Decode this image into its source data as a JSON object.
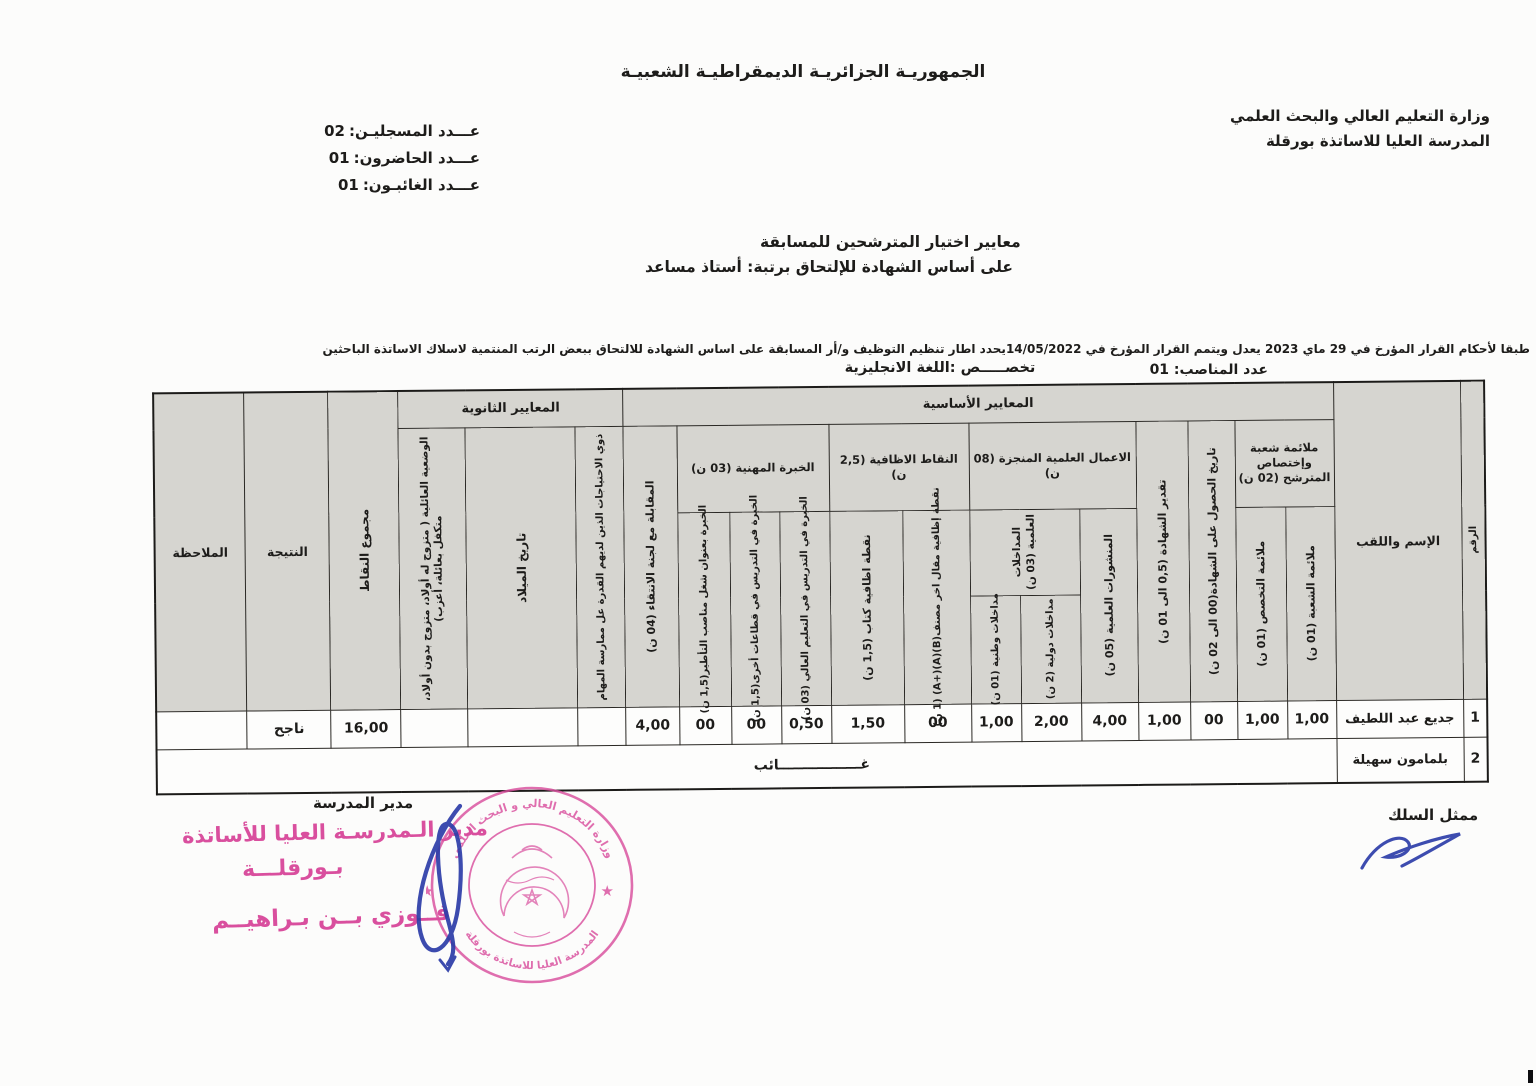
{
  "header": {
    "republic_title": "الجمهوريـة الجزائريـة الديمقراطيـة الشعبيـة",
    "ministry_line1": "وزارة التعليم العالي والبحث العلمي",
    "ministry_line2": "المدرسة العليا للاساتذة بورقلة",
    "stats": [
      {
        "label": "عـــدد المسجليـن:",
        "value": "02"
      },
      {
        "label": "عـــدد الحاضرون:",
        "value": "01"
      },
      {
        "label": "عـــدد الغائبـون:",
        "value": "01"
      }
    ],
    "title_line1": "معايير اختيار المترشحين للمسابقة",
    "title_line2": "على أساس الشهادة للإلتحاق برتبة: أستاذ مساعد",
    "decree_text": "طبقا لأحكام القرار المؤرخ في 29 ماي 2023 يعدل ويتمم القرار المؤرخ في 14/05/2022يحدد اطار تنظيم التوظيف و/أر المسابقة على اساس الشهادة للالتحاق ببعض الرتب المنتمية لاسلاك الاساتذة الباحثين",
    "posts_label": "عدد المناصب:",
    "posts_value": "01",
    "specialty_text": "تخصـــــص :اللغة الانجليزية"
  },
  "table": {
    "headers": {
      "num": "الرقم",
      "name": "الإسم واللقب",
      "basic_band": "المعايير الأساسية",
      "secondary_band": "المعايير الثانوية",
      "fit_band": "ملائمة شعبة وإختصاص المترشح (02 ن)",
      "fit_branch": "ملائمة الشعبة (01 ن)",
      "fit_specialty": "ملائمة التخصص (01 ن)",
      "degree_date": "تاريخ الحصول على الشهادة(00 الى 02 ن)",
      "degree_grade": "تقدير الشهادة (0,5 الى 01 ن)",
      "works_band": "الاعمال العلمية المنجزة   (08 ن)",
      "publications": "المنشورات العلمية (05 ن)",
      "talks_band": "المداخلات العلمية (03 ن)",
      "talks_intl": "مداخلات دولية (2 ن)",
      "talks_natl": "مداخلات وطنية (01 ن)",
      "extra_band": "النقاط الاظافية (2,5 ن)",
      "extra_article": "نقطة إظافية مقال اخر مصنف(B)(A)(+A) (1 ن)",
      "extra_book": "نقطة اظافية كتاب (1,5 ن)",
      "exp_band": "الخبرة المهنية (03 ن)",
      "exp_higher_ed": "الخبرة في التدريس في التعليم العالي (03 ن)",
      "exp_other": "الخبرة في التدريس في قطاعات أخرى(1,5 ن)",
      "exp_management": "الخبرة بعنوان شغل مناصب التأطير(1,5 ن)",
      "interview": "المقابلة مع لجنة الانتقاء (04 ن)",
      "special_needs": "ذوي الاحتياجات الذين لديهم القدرة عل ممارسة المهام",
      "birth_date": "تاريخ الميلاد",
      "family_status": "الوضعية العائلية ( متزوج له أولاد، متزوج بدون أولاد، متكفل بعائلة، أعزب)",
      "total": "مجموع النقاط",
      "result": "النتيجة",
      "note": "الملاحظة"
    },
    "rows": [
      {
        "num": "1",
        "name": "جديع عبد اللطيف",
        "fit_branch": "1,00",
        "fit_specialty": "1,00",
        "degree_date": "00",
        "degree_grade": "1,00",
        "publications": "4,00",
        "talks_intl": "2,00",
        "talks_natl": "1,00",
        "extra_article": "00",
        "extra_book": "1,50",
        "exp_higher_ed": "0,50",
        "exp_other": "00",
        "exp_management": "00",
        "interview": "4,00",
        "special_needs": "",
        "birth_date": "",
        "family_status": "",
        "total": "16,00",
        "result": "ناجح",
        "note": ""
      },
      {
        "num": "2",
        "name": "بلمامون سهيلة",
        "absent": "غـــــــــــــــــائب"
      }
    ]
  },
  "footer": {
    "director_label": "مدير المدرسة",
    "representative_label": "ممثل السلك",
    "stamp_line1": "مدير الـمدرسـة العليا للأساتذة",
    "stamp_line2": "بـورقلـــة",
    "stamp_name": "فــوزي بــن بـراهيــم",
    "seal_top_text": "وزارة التعليم العالي و البحث العلمي",
    "seal_bottom_text": "المدرسة العليا للاساتذة بورقلة"
  },
  "colors": {
    "stamp_pink": "#d94f9e",
    "signature_blue": "#2c3da8",
    "header_cell_bg": "#d6d5d0",
    "border": "#2a2824"
  }
}
